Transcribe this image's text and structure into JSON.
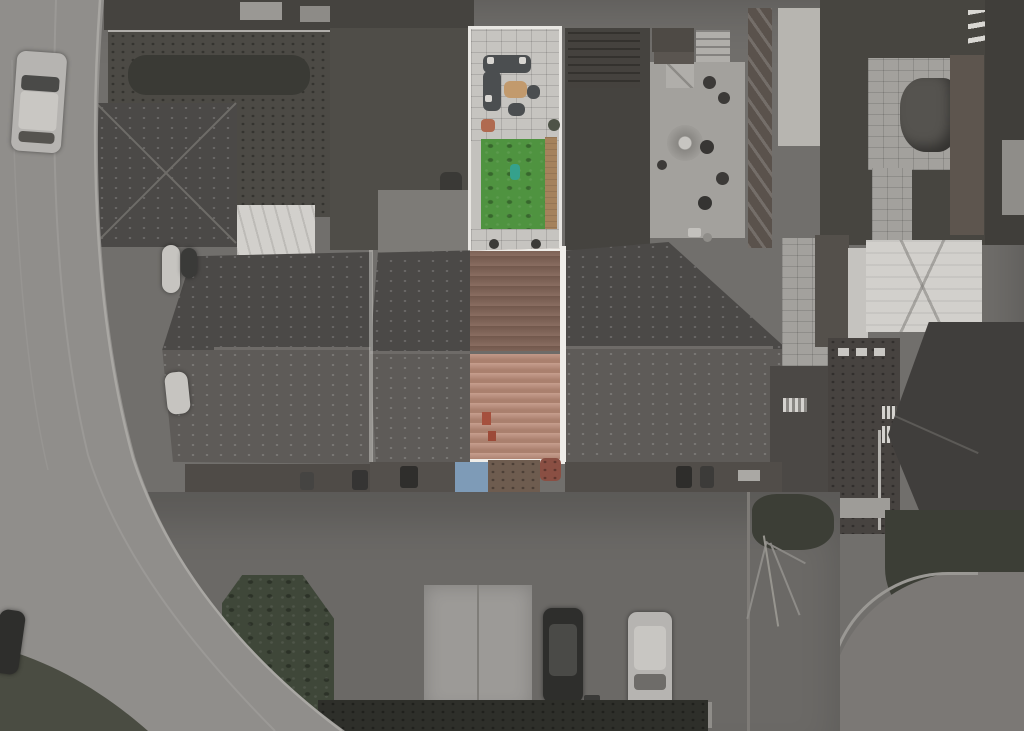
{
  "scene": {
    "description": "Aerial drone photograph of a residential street; one mid-terrace house is highlighted in colour (red tiled roof, green rear lawn, patio furniture) while all surrounding houses, gardens, roads and parked cars are greyscale",
    "colors": {
      "base": "#716f6c",
      "road": "#908e8b",
      "kerb": "#a9a7a3",
      "grass_verge": "#4a4c42",
      "parking": "#6b6966",
      "parking_pad": "#9c9a97",
      "pad_grass": "#5d7a3f",
      "grass_patch": "#3f4739",
      "hedge": "#2e2f2a",
      "tree_canopy": "#3c3e36",
      "garden_grey": "#4c4a45",
      "garden_light": "#a3a19d",
      "shed_light": "#b0aeaa",
      "shed_dark": "#45423e",
      "conservatory": "#d2d0cc",
      "roof_dark_top": "#4b4947",
      "roof_dark_bottom": "#5e5b58",
      "ridge": "#6e6b68",
      "white_trim": "#efede9",
      "highlight_roof_upper": "#826457",
      "highlight_roof_lower": "#bd8e7b",
      "lawn": "#4f9340",
      "patio": "#c6c4c0",
      "wood_planter": "#a5825c",
      "coffee_table": "#c29a6d",
      "sofa": "#4b4e50",
      "toy": "#35a18c",
      "front_canopy": "#7e9bb7",
      "front_gravel": "#6e5c4f",
      "front_red": "#8a4f43",
      "car_dark": "#2e2e2c",
      "car_silver": "#b6b4b1",
      "car_white": "#c6c4c0",
      "brick_house": "#474340",
      "driveway": "#7b7875",
      "fence_dark": "#5a524c"
    },
    "objects": {
      "highlighted_property": "mid-terrace house: red tiled roof, rear garden with corner-sofa patio, artificial lawn, timber planter",
      "terrace_blocks": 3,
      "parked_vehicles": 7
    }
  }
}
